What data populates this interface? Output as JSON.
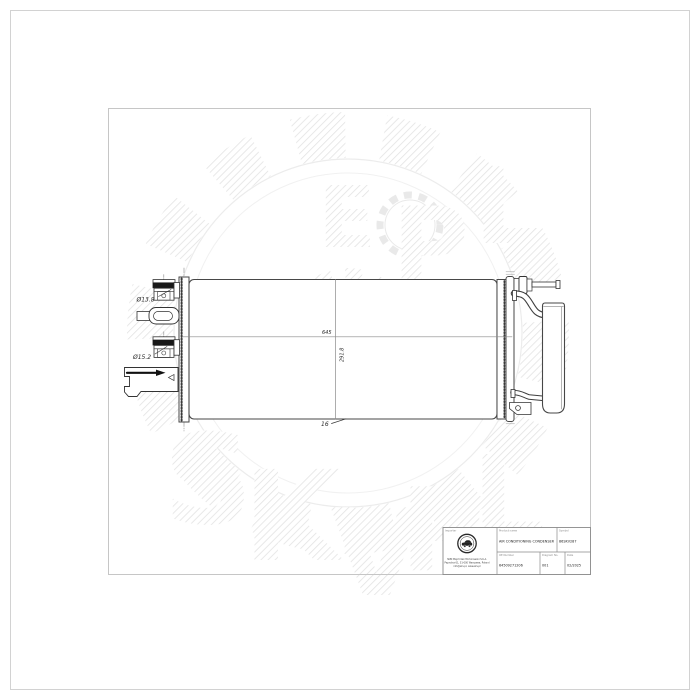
{
  "watermark": {
    "letters": [
      "S",
      "K",
      "V",
      "P",
      "L",
      "E",
      "P",
      "L"
    ],
    "small_text": "kv"
  },
  "drawing": {
    "dim_port_top": "Ø13.8",
    "dim_port_bottom": "Ø15.2",
    "dim_width": "645",
    "dim_height": "291.8",
    "dim_depth": "16"
  },
  "title_block": {
    "importer_label": "Importer",
    "product_name_label": "Product name",
    "product_name": "AIR CONDITIONING CONDENSER",
    "symbol_label": "Symbol",
    "symbol": "86SKV287",
    "oe_number_label": "OE Number",
    "oe_number": "64509271206",
    "diagram_no_label": "Diagram No.",
    "diagram_no": "001",
    "date_label": "Date",
    "date": "02/2025",
    "company_line1": "SKBI Majchrzak Michorowski S.K.A.",
    "company_line2": "Paprotna 61, 51-000 Warszawa, Poland",
    "company_line3": "info@skv.pl, www.skv.pl"
  }
}
